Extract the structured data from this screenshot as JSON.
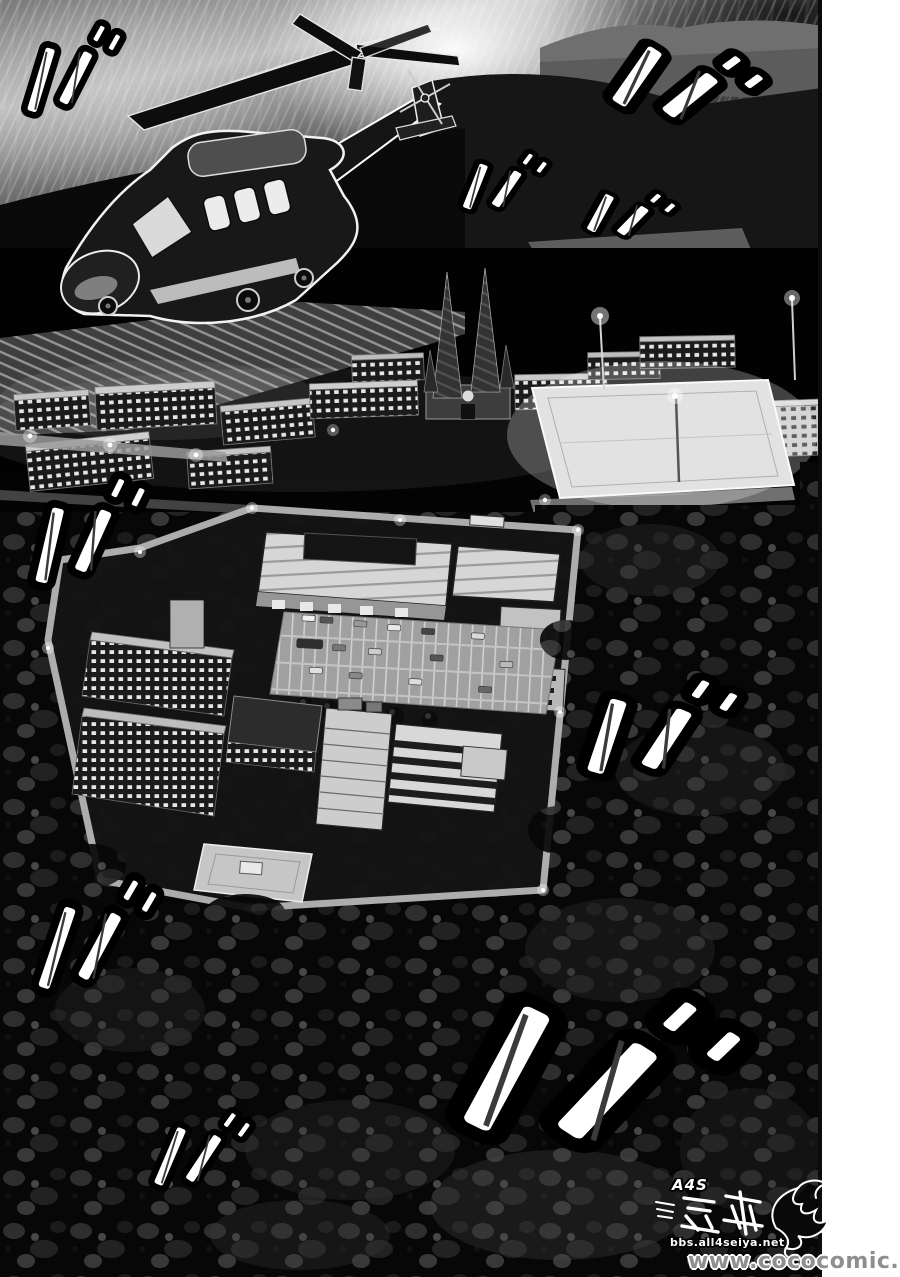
{
  "panel": {
    "objects": [
      "helicopter-icon",
      "cathedral-icon",
      "school-campus",
      "floodlit-field",
      "research-facility",
      "parking-lot",
      "forest"
    ]
  },
  "sound_effects": {
    "glyph": "バ",
    "instances": [
      {
        "x": 72,
        "y": 70,
        "size": 95,
        "sx": 1.05,
        "rotation": 14
      },
      {
        "x": 504,
        "y": 183,
        "size": 68,
        "sx": 1.35,
        "rotation": 18
      },
      {
        "x": 686,
        "y": 85,
        "size": 95,
        "sx": 1.75,
        "rotation": 30
      },
      {
        "x": 630,
        "y": 215,
        "size": 58,
        "sx": 1.7,
        "rotation": 24
      },
      {
        "x": 88,
        "y": 532,
        "size": 110,
        "sx": 1.15,
        "rotation": 10
      },
      {
        "x": 660,
        "y": 729,
        "size": 110,
        "sx": 1.6,
        "rotation": 14
      },
      {
        "x": 96,
        "y": 936,
        "size": 122,
        "sx": 1.0,
        "rotation": 16
      },
      {
        "x": 201,
        "y": 1151,
        "size": 88,
        "sx": 1.1,
        "rotation": 20
      },
      {
        "x": 598,
        "y": 1072,
        "size": 190,
        "sx": 1.6,
        "rotation": 24
      }
    ]
  },
  "scanlation_logo": {
    "group": "A4S",
    "title_cjk": "熱血燃焰",
    "site": "bbs.all4seiya.net"
  },
  "watermark": {
    "text": "www.cococomic.com"
  },
  "colors": {
    "paper_white": "#ffffff",
    "ink_black": "#060606",
    "sky_highlight": "#ededed",
    "building_light": "#d6d6d6",
    "field_glow": "#e9e9e9",
    "watermark_gray": "#8f8f8f"
  }
}
